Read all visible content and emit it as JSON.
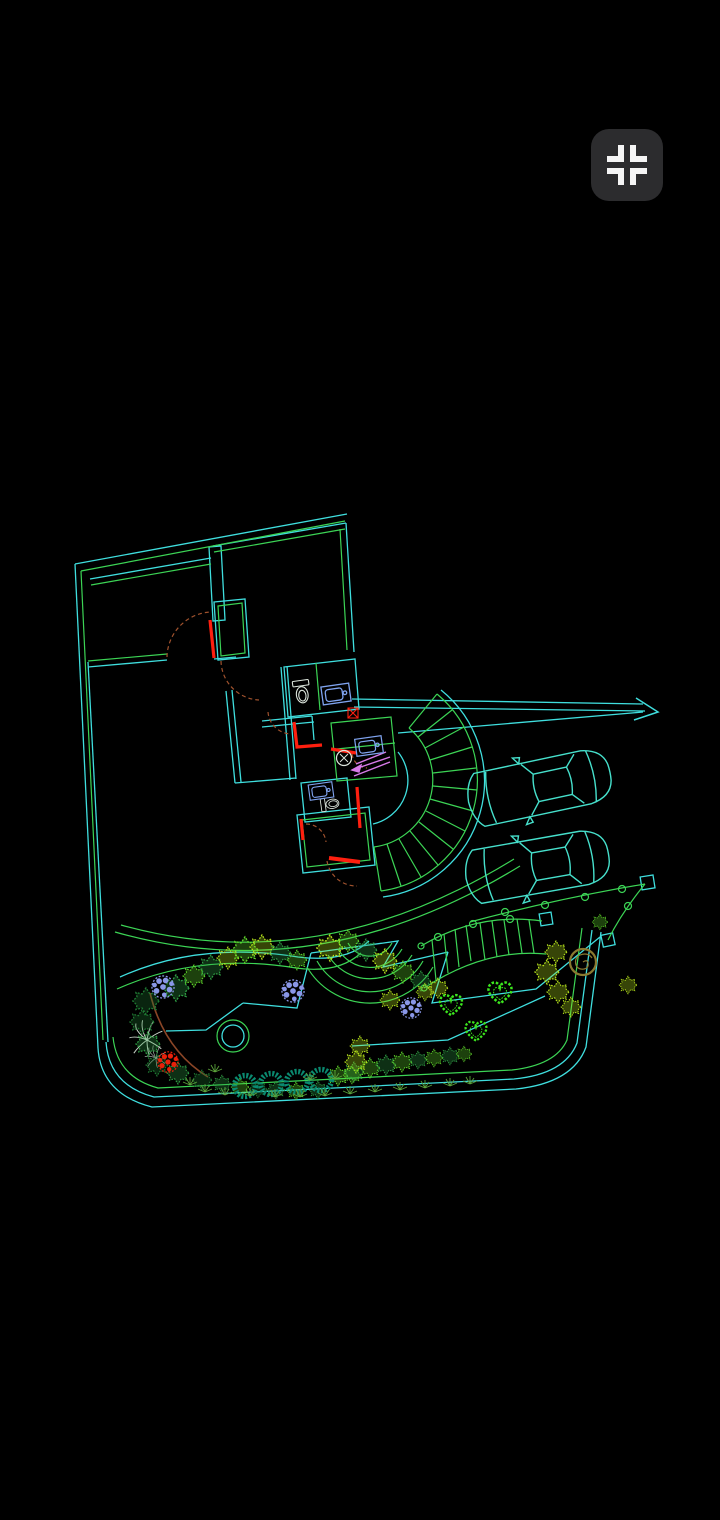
{
  "screen": {
    "width": 720,
    "height": 1520,
    "background": "#000000"
  },
  "toolbar": {
    "fit_button": {
      "icon": "fit-to-screen-icon",
      "bg_color": "#2c2c2e",
      "glyph_color": "#f5f5f5"
    }
  },
  "drawing": {
    "type": "cad-site-plan",
    "description": "Wireframe architectural ground floor plan with landscaped garden, curved stair, terrace steps, two parked cars, driveway arrow, fences, hedges and flower clusters on black background, slightly rotated",
    "counts": {
      "cars": 2,
      "topiary_rings": 4,
      "heart_shrubs": 3,
      "blue_flower_clusters": 3,
      "red_flower_clusters": 1
    },
    "palette": {
      "wall_cyan": "#3fdede",
      "wall_green": "#3cd455",
      "door_red": "#ff1f0f",
      "door_swing_brown": "#a0522d",
      "stair_arrow_magenta": "#d77ae8",
      "fixture_white": "#dde6dd",
      "fixture_blue": "#7fa3ef",
      "car_cyan": "#46e0cc",
      "bush_green_medium": "#2f9e44",
      "bush_green_bright": "#5fd62a",
      "bush_green_dark": "#1f7a33",
      "bush_yellow_green": "#b6e31c",
      "shrub_teal": "#0a8a70",
      "flower_blue": "#8a97e8",
      "flower_red": "#e8200a",
      "tree_olive": "#8a7a30",
      "path_brown": "#8a4526",
      "plant_white": "#c9d4c9"
    },
    "elements": [
      "site-boundary",
      "building-walls",
      "doors",
      "bathroom-fixtures",
      "curved-staircase",
      "terrace-steps",
      "parked-cars",
      "driveway-arrow",
      "garden-fence",
      "trellis-steps",
      "hedges",
      "flower-clusters",
      "topiary-rings",
      "heart-shrubs",
      "fountain-circle",
      "garden-paths"
    ]
  }
}
